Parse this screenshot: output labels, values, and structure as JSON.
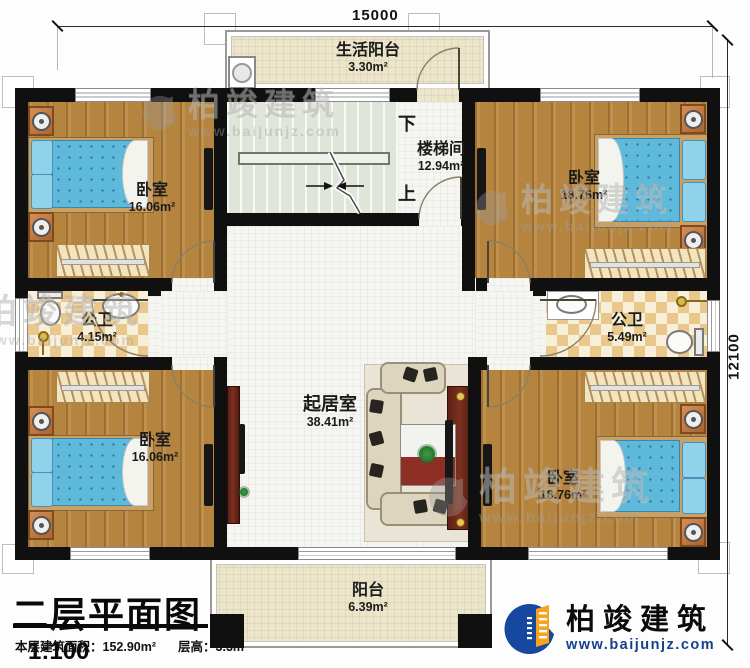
{
  "plan": {
    "dimensions": {
      "width_mm": "15000",
      "height_mm": "12100"
    },
    "rooms": {
      "life_balcony": {
        "name": "生活阳台",
        "area": "3.30m²"
      },
      "stairwell": {
        "name": "楼梯间",
        "area": "12.94m²",
        "down": "下",
        "up": "上"
      },
      "bedroom_tl": {
        "name": "卧室",
        "area": "16.06m²"
      },
      "bedroom_tr": {
        "name": "卧室",
        "area": "18.76m²"
      },
      "bath_left": {
        "name": "公卫",
        "area": "4.15m²"
      },
      "bath_right": {
        "name": "公卫",
        "area": "5.49m²"
      },
      "living": {
        "name": "起居室",
        "area": "38.41m²"
      },
      "bedroom_bl": {
        "name": "卧室",
        "area": "16.06m²"
      },
      "bedroom_br": {
        "name": "卧室",
        "area": "18.76m²"
      },
      "balcony": {
        "name": "阳台",
        "area": "6.39m²"
      }
    }
  },
  "title_block": {
    "title": "二层平面图",
    "scale": "1:100",
    "floor_area": "本层建筑面积：152.90m²",
    "floor_height": "层高：3.3m"
  },
  "brand": {
    "name": "柏竣建筑",
    "website": "www.baijunjz.com"
  },
  "watermark": {
    "name": "柏竣建筑",
    "website": "www.baijunjz.com"
  },
  "colors": {
    "wall": "#101010",
    "wood": "#b5843f",
    "tile": "#f5f5f2",
    "checker": "#eac88c",
    "balcony": "#ede5c9",
    "stairs": "#e0e5da",
    "bed_blue": "#5fb9da",
    "cabinet_maroon": "#5e2015",
    "brand_blue": "#16418c",
    "brand_orange": "#f7a31d"
  }
}
